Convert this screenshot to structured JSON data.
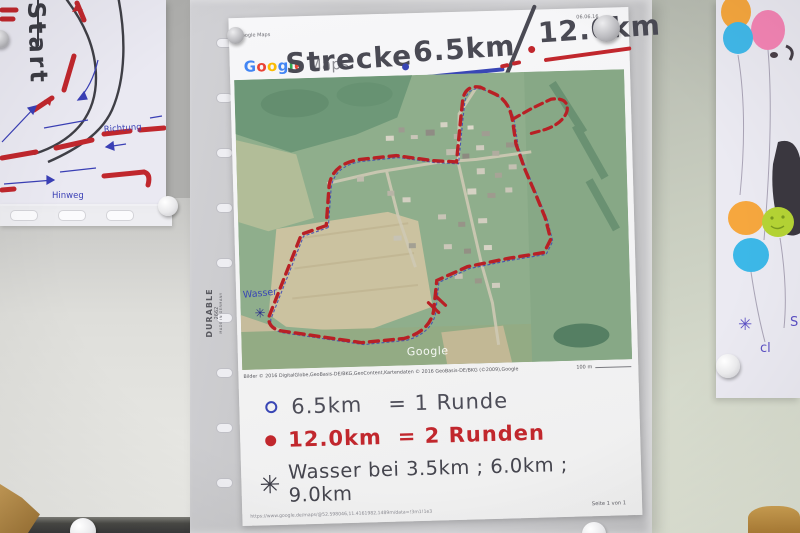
{
  "left_drawing": {
    "start_label": "Start",
    "richtung_label": "Richtung",
    "hinweg_label": "Hinweg"
  },
  "sleeve": {
    "brand": "DURABLE",
    "model": "2662",
    "origin": "MADE IN GERMANY"
  },
  "page": {
    "print_header": "Google Maps",
    "print_date": "06.06.16",
    "logo_letters": [
      [
        "G",
        "#4285F4"
      ],
      [
        "o",
        "#EA4335"
      ],
      [
        "o",
        "#FBBC05"
      ],
      [
        "g",
        "#4285F4"
      ],
      [
        "l",
        "#34A853"
      ],
      [
        "e",
        "#EA4335"
      ]
    ],
    "logo_maps": "Maps",
    "title_strecke": "Strecke",
    "title_dist1": "6.5km",
    "title_dist2": "12.0km",
    "map": {
      "wasser_label": "Wasser",
      "wasser_star": "✳",
      "watermark": "Google",
      "attribution": "Bilder © 2016 DigitalGlobe,GeoBasis-DE/BKG,GeoContent,Kartendaten © 2016 GeoBasis-DE/BKG (©2009),Google",
      "scale_label": "100 m"
    },
    "legend": {
      "row1_dist": "6.5km",
      "row1_eq": "= 1 Runde",
      "row2_dist": "12.0km",
      "row2_eq": "= 2 Runden",
      "row3_star": "✳",
      "row3_text": "Wasser bei 3.5km ; 6.0km ; 9.0km"
    },
    "footer_url": "https://www.google.de/maps/@52.598046,11.4161982,1489m/data=!3m1!1e3",
    "footer_page": "Seite 1 von 1"
  },
  "right_drawing": {
    "star": "✳",
    "partial_text1": "S",
    "partial_text2": "cl"
  },
  "colors": {
    "route_red": "#b82025",
    "route_blue": "#3946b5",
    "ink": "#45454d"
  }
}
